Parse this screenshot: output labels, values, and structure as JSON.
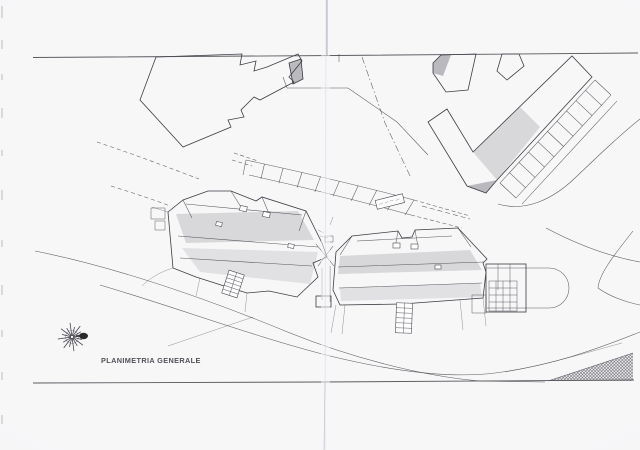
{
  "drawing": {
    "title": "PLANIMETRIA GENERALE",
    "kind_note": "scanned architectural general site plan with hatched building roofs, parking stalls, access roads and a wind-rose north symbol"
  },
  "icons": {
    "compass_rose_icon": "16-ray wind rose star with dark east pointer (drawn as SVG line rays)"
  },
  "colors": {
    "paper": "#f7f7f8",
    "ink": "#3d3d44",
    "hatch": "#56565f",
    "crease": "#9a9aa4"
  }
}
